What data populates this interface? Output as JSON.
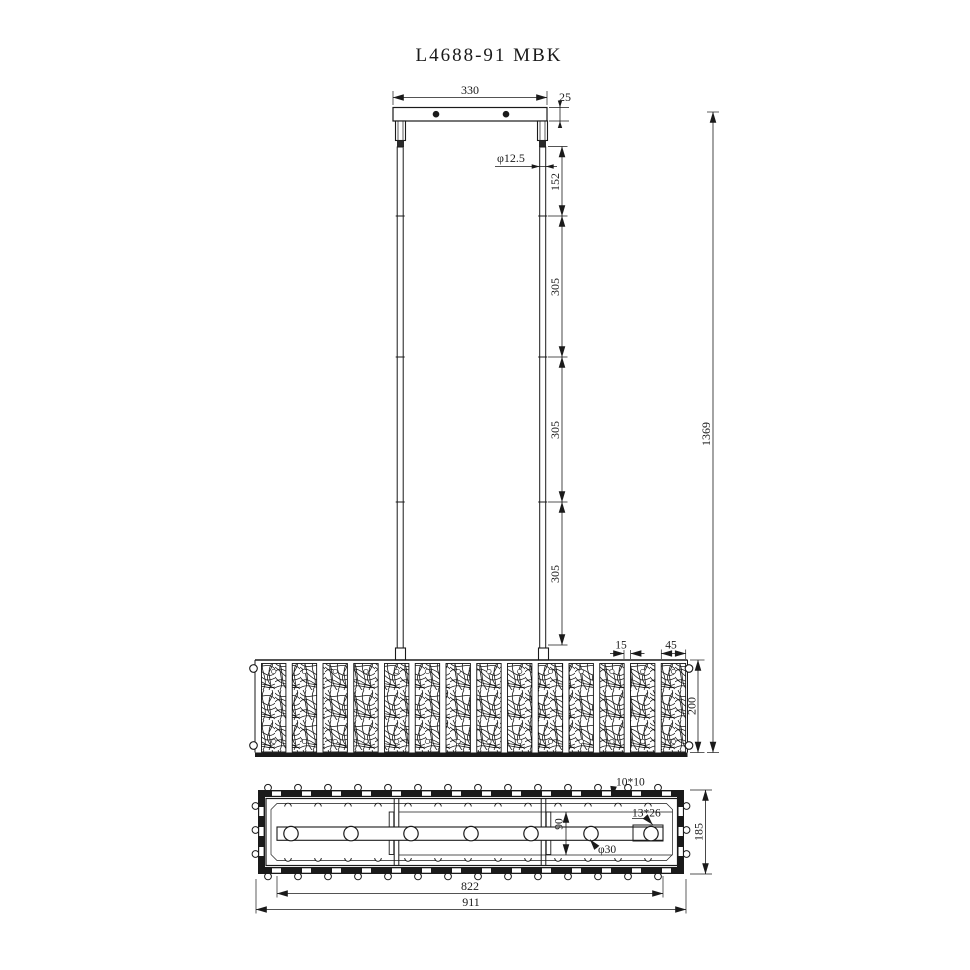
{
  "title": "L4688-91 MBK",
  "colors": {
    "line": "#1a1a1a",
    "background": "#ffffff"
  },
  "front_view": {
    "canopy_width": "330",
    "canopy_thickness": "25",
    "rod_diameter": "φ12.5",
    "rod_segments": [
      "152",
      "305",
      "305",
      "305"
    ],
    "overall_drop": "1369",
    "crystal_gap": "15",
    "crystal_width": "45",
    "shade_height": "200",
    "panel_count": 14
  },
  "plan_view": {
    "bead_size": "10*10",
    "slot_size": "13*26",
    "holder_diameter": "φ30",
    "center_offset": "90",
    "shade_depth": "185",
    "inner_length": "822",
    "overall_length": "911",
    "lamp_count": 7,
    "clip_count": 13,
    "bead_count": 14
  }
}
